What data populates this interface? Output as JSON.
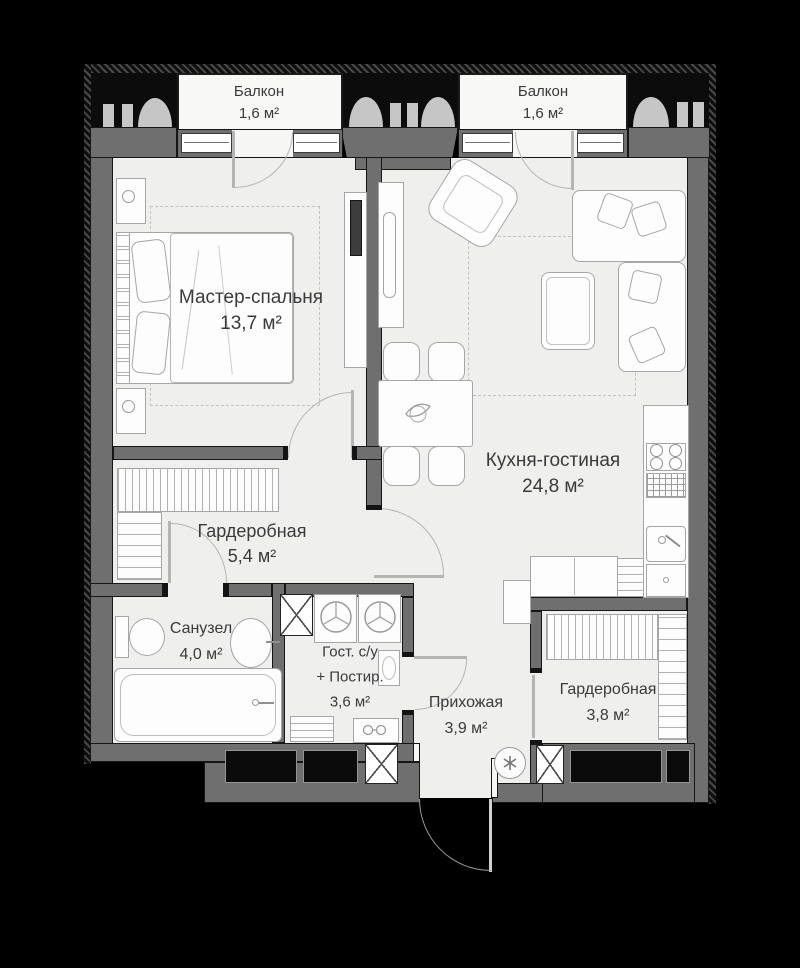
{
  "rooms": [
    {
      "name": "Балкон",
      "area": "1,6 м²"
    },
    {
      "name": "Балкон",
      "area": "1,6 м²"
    },
    {
      "name": "Мастер-спальня",
      "area": "13,7 м²"
    },
    {
      "name": "Кухня-гостиная",
      "area": "24,8 м²"
    },
    {
      "name": "Гардеробная",
      "area": "5,4 м²"
    },
    {
      "name": "Санузел",
      "area": "4,0 м²"
    },
    {
      "name": "Гост. с/у",
      "name_line2": "+ Постир.",
      "area": "3,6 м²"
    },
    {
      "name": "Прихожая",
      "area": "3,9 м²"
    },
    {
      "name": "Гардеробная",
      "area": "3,8 м²"
    }
  ],
  "icons": {
    "ventilation_shaft": "x-cross-box",
    "washing_machine": "circle-with-3-spokes",
    "fan": "circle-asterisk"
  },
  "colors": {
    "wall": "#6f6f6f",
    "floor": "#efefee",
    "outline": "#161616",
    "facade_decor": "#c6c6c6",
    "label_text": "#3a3a3a",
    "furniture_outline": "#a6a6a6",
    "background": "#000000"
  }
}
